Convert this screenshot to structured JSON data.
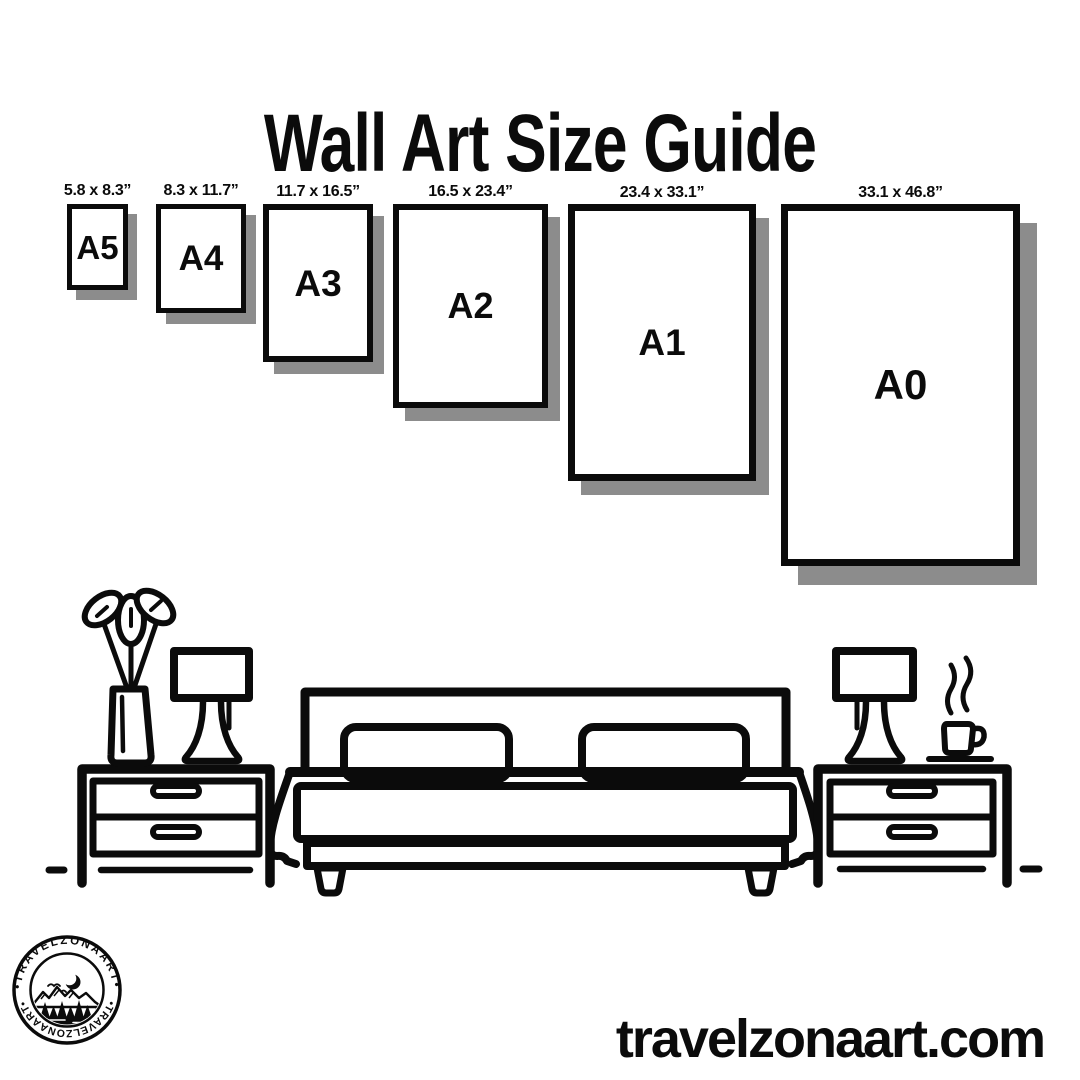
{
  "title": "Wall Art Size Guide",
  "frames": [
    {
      "name": "A5",
      "dims": "5.8 x 8.3”"
    },
    {
      "name": "A4",
      "dims": "8.3 x 11.7”"
    },
    {
      "name": "A3",
      "dims": "11.7 x 16.5”"
    },
    {
      "name": "A2",
      "dims": "16.5 x 23.4”"
    },
    {
      "name": "A1",
      "dims": "23.4 x 33.1”"
    },
    {
      "name": "A0",
      "dims": "33.1 x 46.8”"
    }
  ],
  "logo": {
    "text_top": "•TRAVELZONAART•",
    "text_bottom": "•TRAVELZONAART•"
  },
  "footer": {
    "website": "travelzonaart.com"
  },
  "colors": {
    "ink": "#0b0b0b",
    "shadow": "#8c8c8c",
    "background": "#ffffff"
  },
  "scene": {
    "icons": {
      "plant": "plant-vase-icon",
      "lamp_left": "table-lamp-icon",
      "nightstand_left": "nightstand-icon",
      "bed": "double-bed-icon",
      "pillows": "pillow-icon",
      "lamp_right": "table-lamp-icon",
      "coffee": "coffee-cup-icon",
      "steam": "steam-icon",
      "floor": "floor-line-icon",
      "badge": "travelzonaart-badge-icon"
    }
  }
}
